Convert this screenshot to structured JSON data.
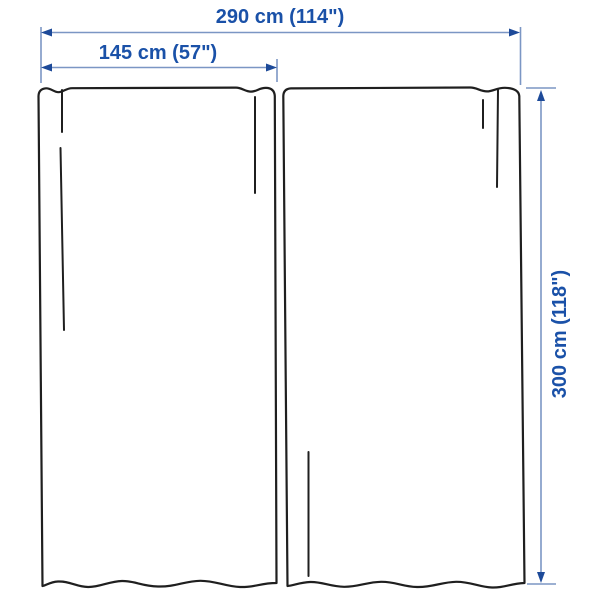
{
  "diagram": {
    "labels": {
      "total_width": "290 cm (114\")",
      "panel_width": "145 cm (57\")",
      "height": "300 cm (118\")"
    },
    "values": {
      "total_width_cm": 290,
      "total_width_in": 114,
      "panel_width_cm": 145,
      "panel_width_in": 57,
      "height_cm": 300,
      "height_in": 118
    },
    "colors": {
      "dimension_line": "#7b96c4",
      "arrow": "#1d4a99",
      "label_text": "#1a51a8",
      "outline": "#1f1f1f"
    }
  }
}
